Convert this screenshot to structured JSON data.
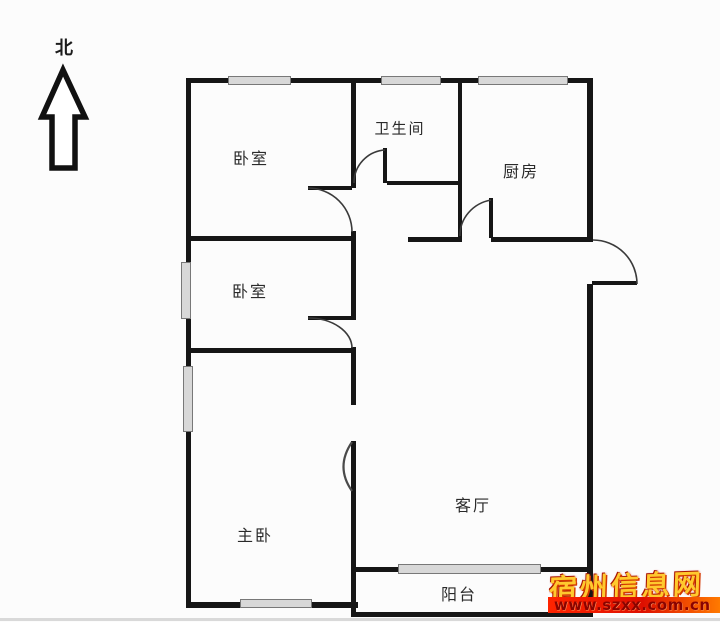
{
  "compass": {
    "label": "北"
  },
  "rooms": [
    {
      "id": "bedroom-top",
      "label": "卧室"
    },
    {
      "id": "bathroom",
      "label": "卫生间"
    },
    {
      "id": "kitchen",
      "label": "厨房"
    },
    {
      "id": "bedroom-middle",
      "label": "卧室"
    },
    {
      "id": "master-bedroom",
      "label": "主卧"
    },
    {
      "id": "living-room",
      "label": "客厅"
    },
    {
      "id": "balcony",
      "label": "阳台"
    }
  ],
  "watermark": {
    "site_name": "宿州信息网",
    "site_url": "www.szxx.com.cn"
  },
  "colors": {
    "wall": "#161616",
    "window_fill": "#d8d8d8",
    "window_border": "#787878",
    "background": "#fcfcfc",
    "label_text": "#2a2a2a",
    "watermark_gold": "#ffc92e",
    "watermark_red": "#dd0f00"
  }
}
